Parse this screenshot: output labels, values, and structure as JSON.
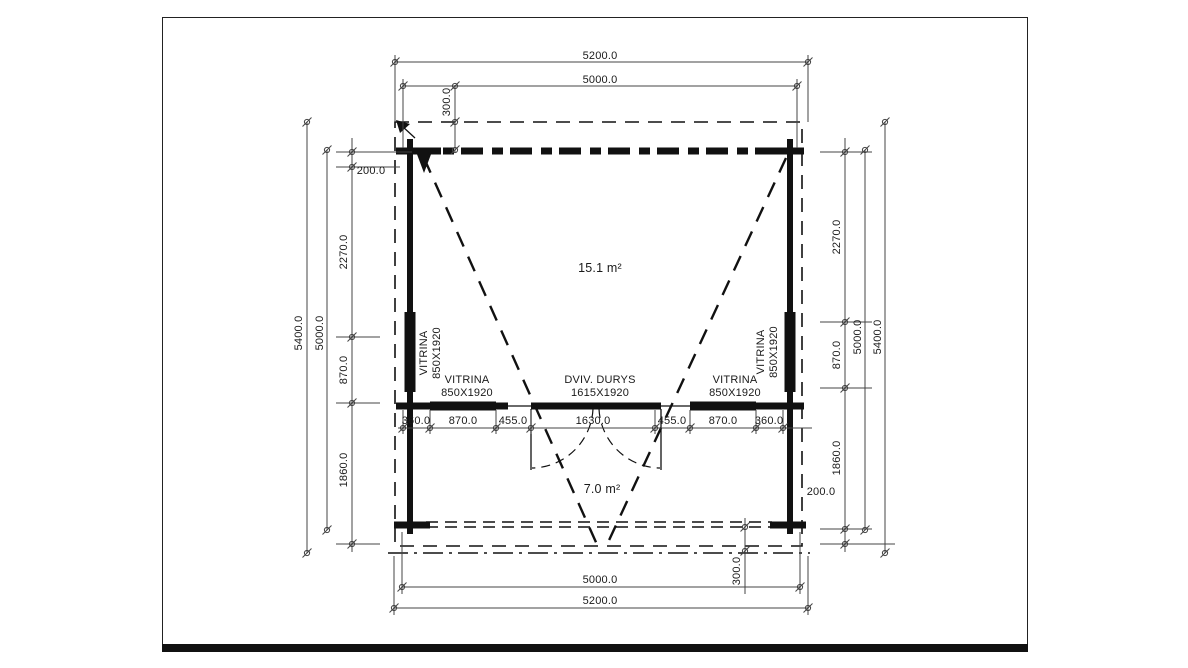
{
  "drawing": {
    "type_label": "floor plan",
    "rooms": {
      "main_area": "15.1 m²",
      "terrace_area": "7.0 m²"
    },
    "openings": {
      "left_wall_window": {
        "name": "VITRINA",
        "size": "850X1920"
      },
      "right_wall_window": {
        "name": "VITRINA",
        "size": "850X1920"
      },
      "mid_left_window": {
        "name": "VITRINA",
        "size": "850X1920"
      },
      "mid_right_window": {
        "name": "VITRINA",
        "size": "850X1920"
      },
      "door": {
        "name": "DVIV. DURYS",
        "size": "1615X1920"
      }
    },
    "dimensions": {
      "top": {
        "outer": "5200.0",
        "inner": "5000.0",
        "roof_overhang": "300.0"
      },
      "bottom": {
        "inner": "5000.0",
        "outer": "5200.0",
        "roof_overhang": "300.0"
      },
      "left": {
        "overall": "5400.0",
        "wall_to_wall": "5000.0",
        "top_offset": "200.0",
        "chain": [
          "2270.0",
          "870.0",
          "1860.0"
        ]
      },
      "right": {
        "overall": "5400.0",
        "wall_to_wall": "5000.0",
        "bottom_offset": "200.0",
        "chain": [
          "2270.0",
          "870.0",
          "1860.0"
        ]
      },
      "front_wall_chain": [
        "360.0",
        "870.0",
        "455.0",
        "1630.0",
        "455.0",
        "870.0",
        "360.0"
      ]
    },
    "colors": {
      "line": "#111111",
      "dim_line": "#444444",
      "background": "#ffffff"
    }
  }
}
